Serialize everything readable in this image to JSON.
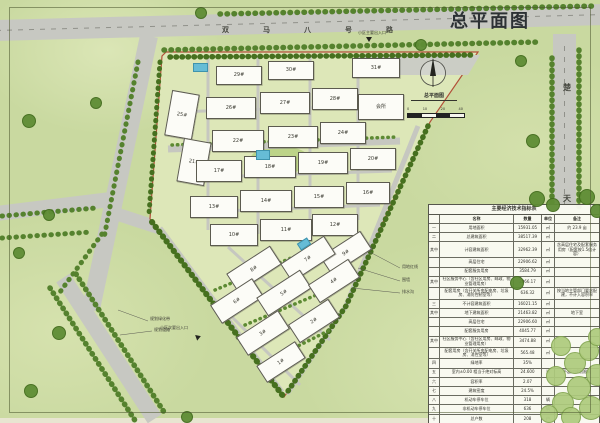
{
  "drawing": {
    "title": "总平面图"
  },
  "roads": {
    "top_name": "双马八号路",
    "right_chars": [
      "楚",
      "天"
    ]
  },
  "compass": {
    "label": "总平面图",
    "scale_text": [
      "0",
      "10",
      "20",
      "40"
    ]
  },
  "entrances": {
    "main": "小区主要出入口",
    "secondary": "小区次要出入口"
  },
  "annotations": {
    "boundary": [
      "用地红线",
      "围墙",
      "排水沟"
    ],
    "southwest": [
      "规划绿化带",
      "规划道路"
    ]
  },
  "colors": {
    "paper": "#c9d9a0",
    "road": "#c7c8c2",
    "tree": "#5f8d35",
    "boundary_red": "#b24f38",
    "pool": "#66bcd6"
  },
  "buildings": [
    {
      "label": "29#",
      "x": 216,
      "y": 66,
      "w": 44,
      "h": 17,
      "rot": 0
    },
    {
      "label": "30#",
      "x": 268,
      "y": 61,
      "w": 44,
      "h": 17,
      "rot": 0
    },
    {
      "label": "31#",
      "x": 352,
      "y": 58,
      "w": 46,
      "h": 18,
      "rot": 0
    },
    {
      "label": "25#",
      "x": 168,
      "y": 92,
      "w": 26,
      "h": 44,
      "rot": 10
    },
    {
      "label": "26#",
      "x": 206,
      "y": 97,
      "w": 48,
      "h": 20,
      "rot": 0
    },
    {
      "label": "27#",
      "x": 260,
      "y": 92,
      "w": 48,
      "h": 20,
      "rot": 0
    },
    {
      "label": "28#",
      "x": 312,
      "y": 88,
      "w": 44,
      "h": 20,
      "rot": 0
    },
    {
      "label": "会所",
      "x": 358,
      "y": 94,
      "w": 44,
      "h": 24,
      "rot": 0
    },
    {
      "label": "21#",
      "x": 180,
      "y": 140,
      "w": 26,
      "h": 42,
      "rot": 10
    },
    {
      "label": "22#",
      "x": 212,
      "y": 130,
      "w": 50,
      "h": 20,
      "rot": 0
    },
    {
      "label": "23#",
      "x": 268,
      "y": 126,
      "w": 48,
      "h": 20,
      "rot": 0
    },
    {
      "label": "24#",
      "x": 320,
      "y": 122,
      "w": 44,
      "h": 20,
      "rot": 0
    },
    {
      "label": "17#",
      "x": 196,
      "y": 160,
      "w": 44,
      "h": 20,
      "rot": 0
    },
    {
      "label": "18#",
      "x": 244,
      "y": 156,
      "w": 50,
      "h": 20,
      "rot": 0
    },
    {
      "label": "19#",
      "x": 298,
      "y": 152,
      "w": 48,
      "h": 20,
      "rot": 0
    },
    {
      "label": "20#",
      "x": 350,
      "y": 148,
      "w": 44,
      "h": 20,
      "rot": 0
    },
    {
      "label": "13#",
      "x": 190,
      "y": 196,
      "w": 46,
      "h": 20,
      "rot": 0
    },
    {
      "label": "14#",
      "x": 240,
      "y": 190,
      "w": 50,
      "h": 20,
      "rot": 0
    },
    {
      "label": "15#",
      "x": 294,
      "y": 186,
      "w": 48,
      "h": 20,
      "rot": 0
    },
    {
      "label": "16#",
      "x": 346,
      "y": 182,
      "w": 42,
      "h": 20,
      "rot": 0
    },
    {
      "label": "10#",
      "x": 210,
      "y": 224,
      "w": 46,
      "h": 20,
      "rot": 0
    },
    {
      "label": "11#",
      "x": 260,
      "y": 219,
      "w": 50,
      "h": 20,
      "rot": 0
    },
    {
      "label": "12#",
      "x": 312,
      "y": 214,
      "w": 44,
      "h": 20,
      "rot": 0
    },
    {
      "label": "9#",
      "x": 322,
      "y": 242,
      "w": 46,
      "h": 20,
      "rot": -33
    },
    {
      "label": "8#",
      "x": 228,
      "y": 258,
      "w": 50,
      "h": 20,
      "rot": -33
    },
    {
      "label": "7#",
      "x": 282,
      "y": 248,
      "w": 50,
      "h": 20,
      "rot": -33
    },
    {
      "label": "6#",
      "x": 212,
      "y": 290,
      "w": 48,
      "h": 20,
      "rot": -33
    },
    {
      "label": "5#",
      "x": 258,
      "y": 282,
      "w": 50,
      "h": 20,
      "rot": -33
    },
    {
      "label": "4#",
      "x": 310,
      "y": 270,
      "w": 46,
      "h": 20,
      "rot": -33
    },
    {
      "label": "3#",
      "x": 238,
      "y": 322,
      "w": 48,
      "h": 20,
      "rot": -33
    },
    {
      "label": "2#",
      "x": 290,
      "y": 310,
      "w": 46,
      "h": 20,
      "rot": -33
    },
    {
      "label": "1#",
      "x": 258,
      "y": 352,
      "w": 44,
      "h": 18,
      "rot": -33
    }
  ],
  "pools": [
    {
      "x": 193,
      "y": 63,
      "w": 13,
      "h": 7,
      "rot": 0
    },
    {
      "x": 256,
      "y": 150,
      "w": 12,
      "h": 8,
      "rot": 0
    },
    {
      "x": 298,
      "y": 240,
      "w": 10,
      "h": 6,
      "rot": -33
    }
  ],
  "trees": [
    {
      "x": 28,
      "y": 120,
      "r": 6,
      "tone": "dark"
    },
    {
      "x": 18,
      "y": 252,
      "r": 5,
      "tone": "dark"
    },
    {
      "x": 48,
      "y": 214,
      "r": 5,
      "tone": "dark"
    },
    {
      "x": 95,
      "y": 102,
      "r": 5,
      "tone": "dark"
    },
    {
      "x": 58,
      "y": 332,
      "r": 6,
      "tone": "dark"
    },
    {
      "x": 30,
      "y": 390,
      "r": 6,
      "tone": "dark"
    },
    {
      "x": 186,
      "y": 416,
      "r": 5,
      "tone": "dark"
    },
    {
      "x": 520,
      "y": 60,
      "r": 5,
      "tone": "dark"
    },
    {
      "x": 532,
      "y": 140,
      "r": 6,
      "tone": "dark"
    },
    {
      "x": 516,
      "y": 282,
      "r": 6,
      "tone": "dark"
    },
    {
      "x": 536,
      "y": 198,
      "r": 7,
      "tone": "dark"
    },
    {
      "x": 552,
      "y": 204,
      "r": 6,
      "tone": "dark"
    },
    {
      "x": 586,
      "y": 196,
      "r": 7,
      "tone": "dark"
    },
    {
      "x": 596,
      "y": 210,
      "r": 6,
      "tone": "dark"
    },
    {
      "x": 420,
      "y": 44,
      "r": 5,
      "tone": "dark"
    },
    {
      "x": 200,
      "y": 12,
      "r": 5,
      "tone": "dark"
    },
    {
      "x": 560,
      "y": 345,
      "r": 9,
      "tone": "light"
    },
    {
      "x": 574,
      "y": 362,
      "r": 10,
      "tone": "light"
    },
    {
      "x": 588,
      "y": 350,
      "r": 9,
      "tone": "light"
    },
    {
      "x": 596,
      "y": 374,
      "r": 10,
      "tone": "light"
    },
    {
      "x": 578,
      "y": 387,
      "r": 11,
      "tone": "light"
    },
    {
      "x": 562,
      "y": 402,
      "r": 10,
      "tone": "light"
    },
    {
      "x": 590,
      "y": 407,
      "r": 11,
      "tone": "light"
    },
    {
      "x": 570,
      "y": 416,
      "r": 9,
      "tone": "light"
    },
    {
      "x": 548,
      "y": 413,
      "r": 8,
      "tone": "light"
    },
    {
      "x": 596,
      "y": 336,
      "r": 8,
      "tone": "light"
    },
    {
      "x": 555,
      "y": 375,
      "r": 9,
      "tone": "light"
    }
  ],
  "table": {
    "title": "主要经济技术指标表",
    "headers": {
      "seq": "",
      "name": "名称",
      "qty": "数量",
      "unit": "单位",
      "note": "备注"
    },
    "rows": [
      {
        "seq": "一",
        "name": "用地面积",
        "qty": "15931.05",
        "unit": "㎡",
        "note": "约 23.9 亩"
      },
      {
        "seq": "二",
        "name": "总建筑面积",
        "qty": "38517.39",
        "unit": "㎡",
        "note": ""
      },
      {
        "seq": "其中",
        "name": "计容建筑面积",
        "qty": "32962.39",
        "unit": "㎡",
        "note": "含高层住宅及配套服务用房（配套按1.5倍计容）"
      },
      {
        "seq": "",
        "name": "高层住宅",
        "qty": "22906.62",
        "unit": "㎡",
        "note": ""
      },
      {
        "seq": "",
        "name": "配套服务用房",
        "qty": "3584.79",
        "unit": "㎡",
        "note": ""
      },
      {
        "seq": "其中",
        "name": "社区服务中心（含社区用房、邮政、物业管理用房）",
        "qty": "2066.17",
        "unit": "㎡",
        "note": ""
      },
      {
        "seq": "",
        "name": "配套用房（含开关所变配电房、垃圾房、消防控制室等）",
        "qty": "636.32",
        "unit": "㎡",
        "note": "按当地主管部门要求配建，不计入容积率"
      },
      {
        "seq": "三",
        "name": "不计容建筑面积",
        "qty": "16021.15",
        "unit": "㎡",
        "note": ""
      },
      {
        "seq": "其中",
        "name": "地下建筑面积",
        "qty": "21463.82",
        "unit": "㎡",
        "note": "地下室"
      },
      {
        "seq": "",
        "name": "高层住宅",
        "qty": "22906.60",
        "unit": "㎡",
        "note": ""
      },
      {
        "seq": "",
        "name": "配套服务用房",
        "qty": "4045.77",
        "unit": "㎡",
        "note": ""
      },
      {
        "seq": "其中",
        "name": "社区服务中心（含社区用房、邮政、物业管理用房）",
        "qty": "3474.88",
        "unit": "㎡",
        "note": ""
      },
      {
        "seq": "",
        "name": "配套用房（含开关所变配电房、垃圾房、消控室等）",
        "qty": "565.48",
        "unit": "㎡",
        "note": ""
      },
      {
        "seq": "四",
        "name": "绿地率",
        "qty": "35%",
        "unit": "",
        "note": ""
      },
      {
        "seq": "五",
        "name": "室内±0.00 相当于绝对标高",
        "qty": "24.600",
        "unit": "米",
        "note": "不超过规划限高"
      },
      {
        "seq": "六",
        "name": "容积率",
        "qty": "2.07",
        "unit": "",
        "note": ""
      },
      {
        "seq": "七",
        "name": "建筑密度",
        "qty": "24.5%",
        "unit": "",
        "note": ""
      },
      {
        "seq": "八",
        "name": "机动车停车位",
        "qty": "318",
        "unit": "辆",
        "note": ""
      },
      {
        "seq": "九",
        "name": "非机动车停车位",
        "qty": "636",
        "unit": "辆",
        "note": ""
      },
      {
        "seq": "十",
        "name": "总户数",
        "qty": "208",
        "unit": "户",
        "note": ""
      }
    ]
  }
}
